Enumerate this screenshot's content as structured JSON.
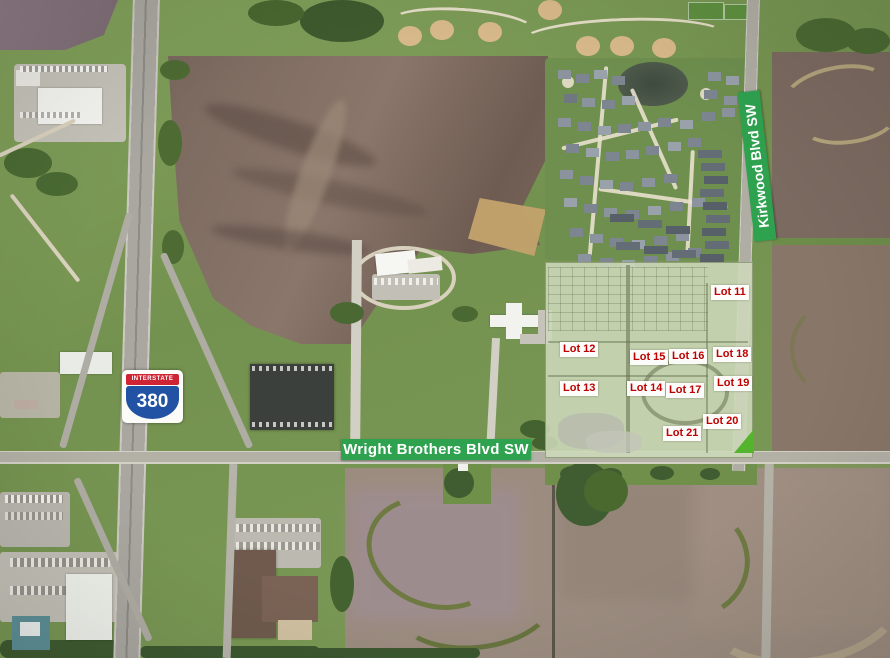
{
  "roads": {
    "horizontal_banner": "Wright Brothers Blvd SW",
    "vertical_banner": "Kirkwood Blvd SW"
  },
  "interstate_shield": {
    "header": "INTERSTATE",
    "number": "380"
  },
  "lots": [
    {
      "label": "Lot 11"
    },
    {
      "label": "Lot 12"
    },
    {
      "label": "Lot 13"
    },
    {
      "label": "Lot 14"
    },
    {
      "label": "Lot 15"
    },
    {
      "label": "Lot 16"
    },
    {
      "label": "Lot 17"
    },
    {
      "label": "Lot 18"
    },
    {
      "label": "Lot 19"
    },
    {
      "label": "Lot 20"
    },
    {
      "label": "Lot 21"
    }
  ],
  "colors": {
    "road_banner_green": "#2ea24f",
    "lot_label_red": "#c00000",
    "lot_label_background": "#ffffff",
    "interstate_shield_red": "#ce2433",
    "interstate_shield_blue": "#2152a3",
    "development_overlay_green": "#cdd8bc"
  }
}
